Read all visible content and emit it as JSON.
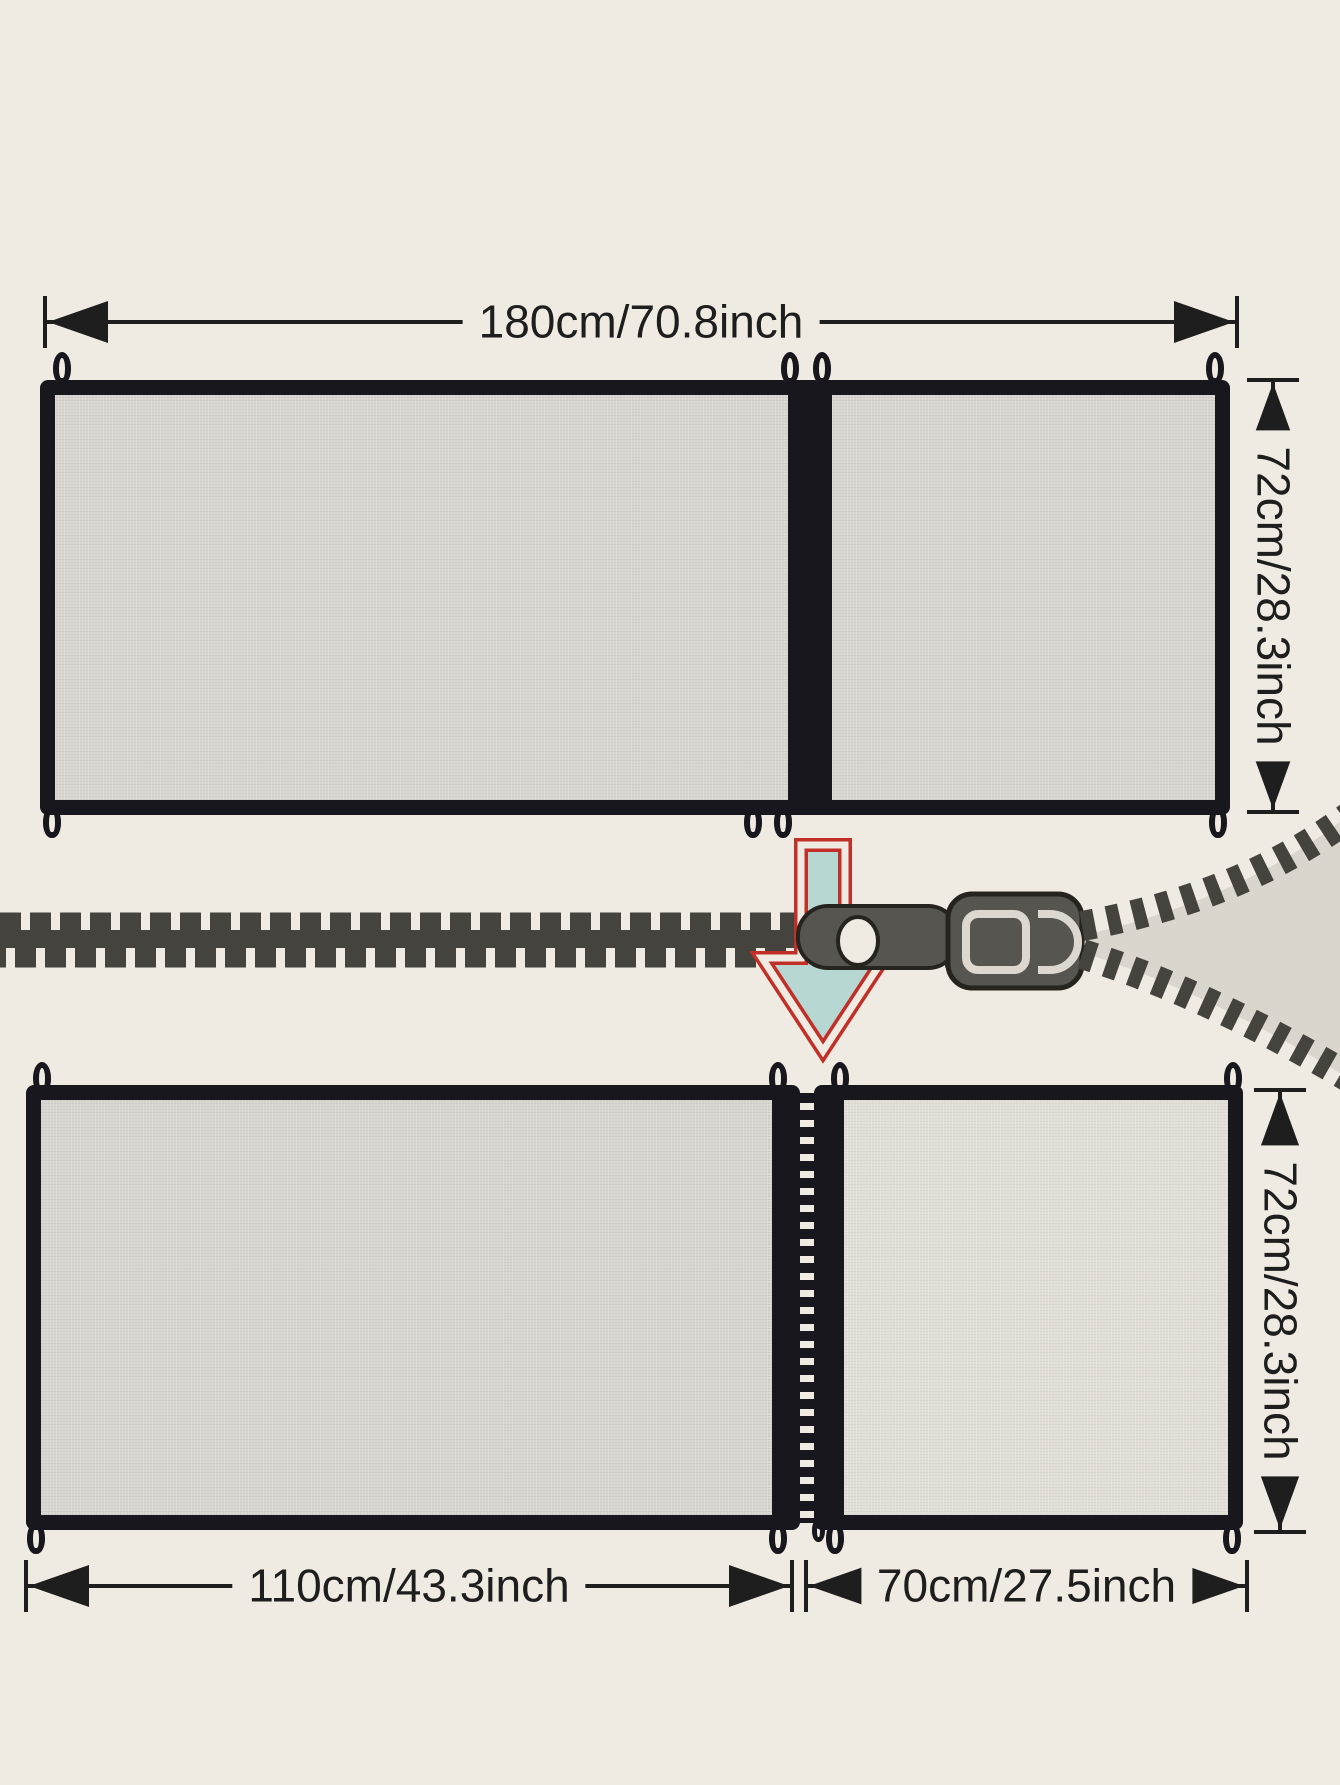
{
  "title": "Zip-apart mesh safety gate dimension diagram",
  "labels": {
    "top_width": "180cm/70.8inch",
    "top_height": "72cm/28.3inch",
    "bottom_left_width": "110cm/43.3inch",
    "bottom_right_width": "70cm/27.5inch",
    "bottom_right_height": "72cm/28.3inch"
  },
  "icons": {
    "zipper_slider": "zipper-slider-icon",
    "unzip_arrow": "down-arrow-icon",
    "zipper_band": "zipper-teeth-icon"
  },
  "colors": {
    "bg": "#f0ebe2",
    "border": "#17171d",
    "mesh": "#d8d4cf",
    "mesh-light": "#e2ded7",
    "dim": "#1e1e1e",
    "zip": "#45433d",
    "wedge": "#dad6ce",
    "slider": "#57554f",
    "slider-dark": "#26241f",
    "slider-light": "#dcd8d0",
    "arrow-fill": "#b7d7d3",
    "arrow-stroke": "#c03028"
  }
}
